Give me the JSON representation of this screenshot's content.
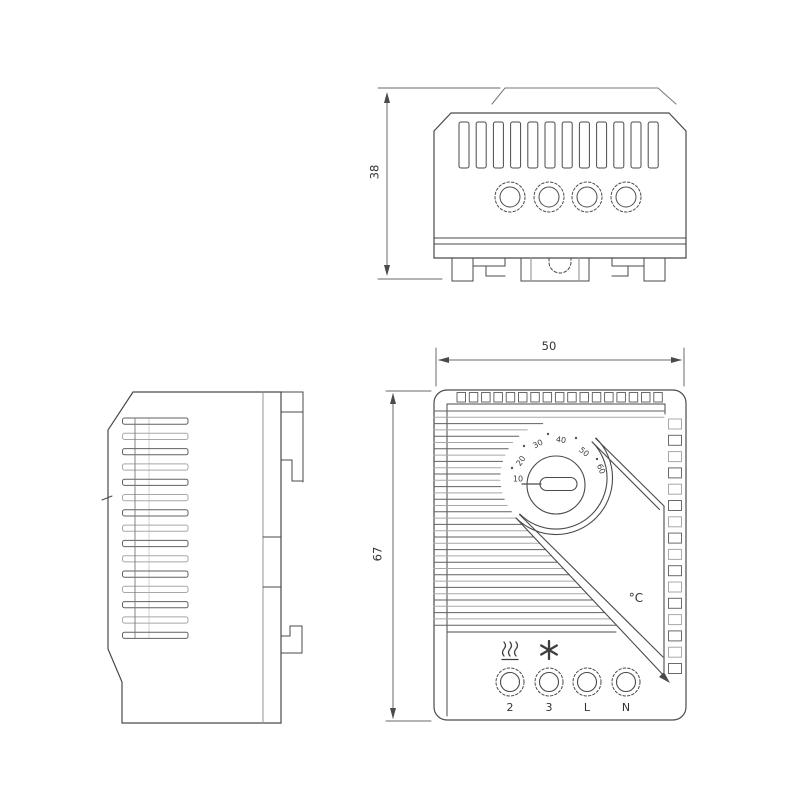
{
  "drawing": {
    "background_color": "#ffffff",
    "line_color": "#4a4a4a",
    "light_line_color": "#a8a8a8"
  },
  "top_view": {
    "depth_dimension": "38",
    "vent_slot_count": 12,
    "terminal_count": 4
  },
  "side_view": {
    "vent_slot_count": 15
  },
  "front_view": {
    "width_dimension": "50",
    "height_dimension": "67",
    "top_comb_slot_count": 17,
    "right_vent_slot_count": 16,
    "left_vent_line_count": 35,
    "dial": {
      "scale_labels": [
        "10",
        "20",
        "30",
        "40",
        "50",
        "60"
      ],
      "unit_label": "°C"
    },
    "terminal_labels": [
      "2",
      "3",
      "L",
      "N"
    ],
    "symbols": [
      "heating",
      "fan"
    ]
  }
}
